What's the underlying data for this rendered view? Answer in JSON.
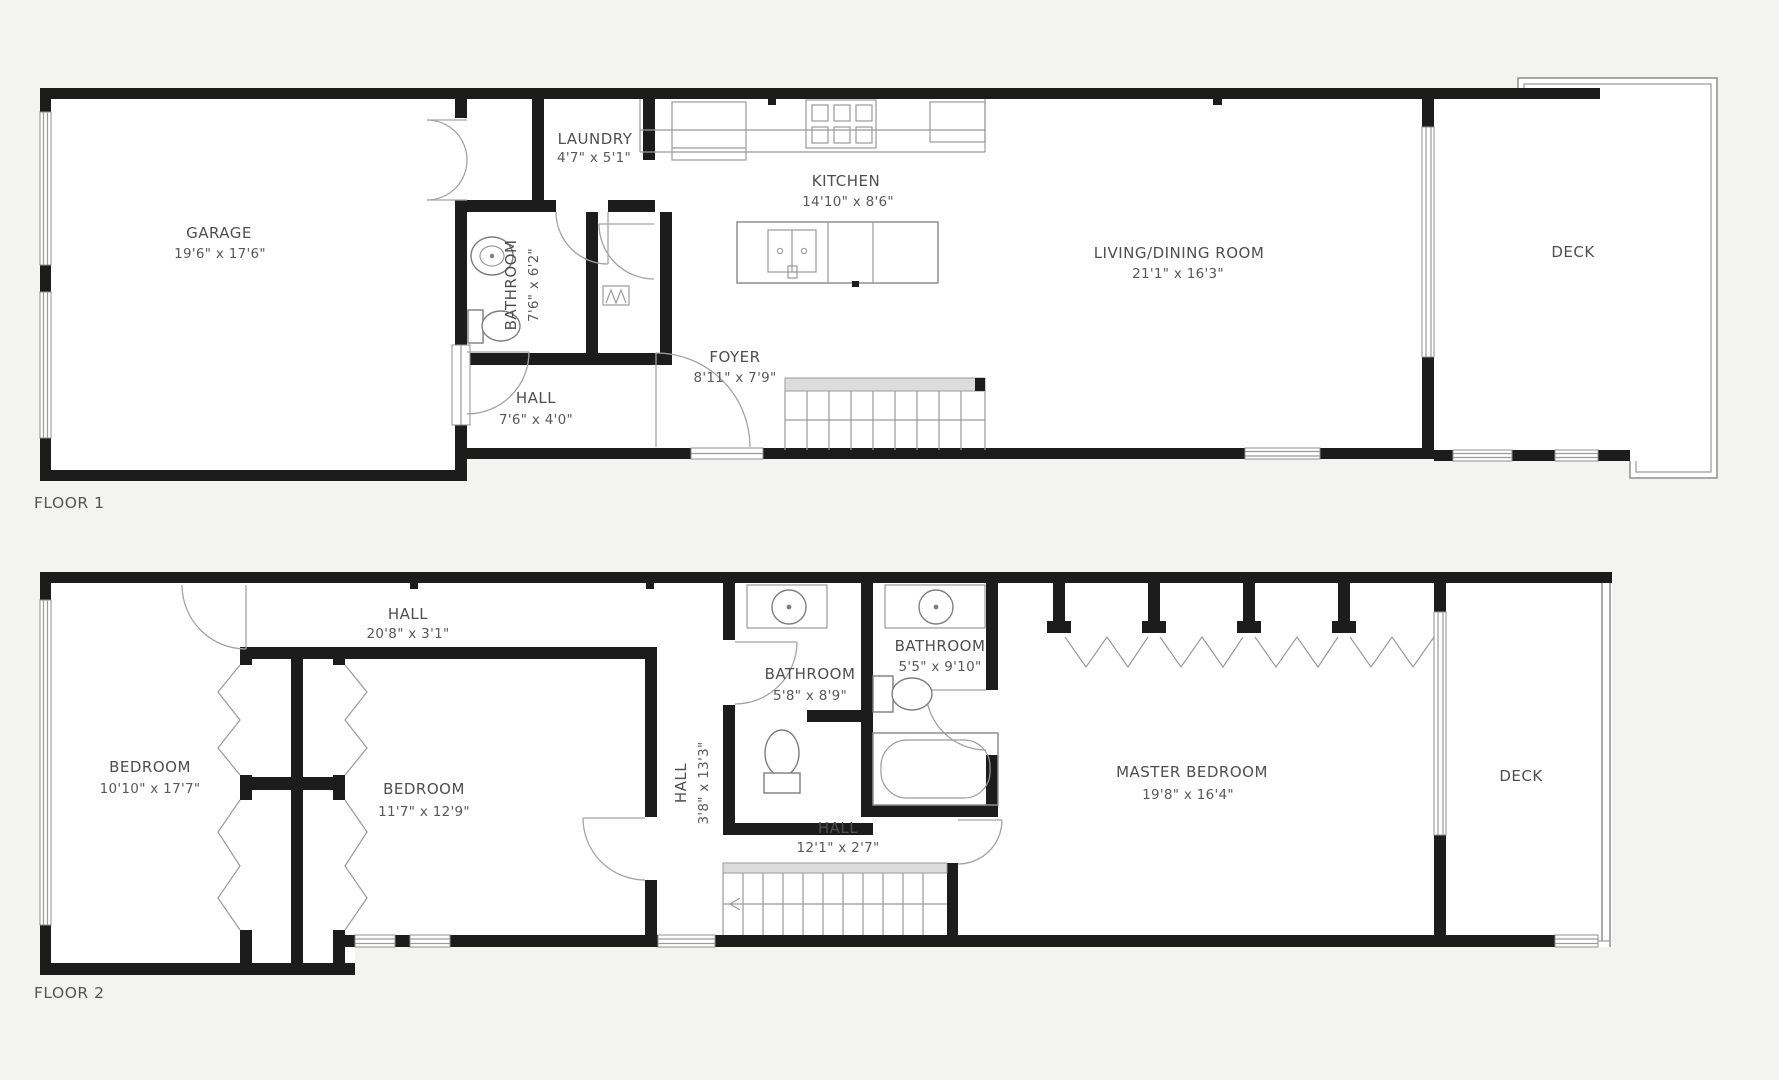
{
  "page": {
    "background": "#f3f3f1",
    "paper": "#ffffff"
  },
  "colors": {
    "wall": "#1c1c1c",
    "thin_line": "#8f8f8f",
    "text": "#4e4e4e",
    "stair_fill": "#dcdcdc"
  },
  "floor1": {
    "label": "FLOOR 1",
    "rooms": {
      "garage": {
        "name": "GARAGE",
        "dims": "19'6\" x 17'6\""
      },
      "laundry": {
        "name": "LAUNDRY",
        "dims": "4'7\" x 5'1\""
      },
      "bathroom": {
        "name": "BATHROOM",
        "dims": "7'6\" x 6'2\""
      },
      "hall": {
        "name": "HALL",
        "dims": "7'6\" x 4'0\""
      },
      "kitchen": {
        "name": "KITCHEN",
        "dims": "14'10\" x 8'6\""
      },
      "foyer": {
        "name": "FOYER",
        "dims": "8'11\" x 7'9\""
      },
      "living_dining": {
        "name": "LIVING/DINING ROOM",
        "dims": "21'1\" x 16'3\""
      },
      "deck": {
        "name": "DECK"
      }
    }
  },
  "floor2": {
    "label": "FLOOR 2",
    "rooms": {
      "hall_top": {
        "name": "HALL",
        "dims": "20'8\" x 3'1\""
      },
      "bedroom_left": {
        "name": "BEDROOM",
        "dims": "10'10\" x 17'7\""
      },
      "bedroom_middle": {
        "name": "BEDROOM",
        "dims": "11'7\" x 12'9\""
      },
      "hall_vertical": {
        "name": "HALL",
        "dims": "3'8\" x 13'3\""
      },
      "bathroom_hall": {
        "name": "BATHROOM",
        "dims": "5'8\" x 8'9\""
      },
      "bathroom_master": {
        "name": "BATHROOM",
        "dims": "5'5\" x 9'10\""
      },
      "hall_bottom": {
        "name": "HALL",
        "dims": "12'1\" x 2'7\""
      },
      "master_bedroom": {
        "name": "MASTER BEDROOM",
        "dims": "19'8\" x 16'4\""
      },
      "deck": {
        "name": "DECK"
      }
    }
  }
}
